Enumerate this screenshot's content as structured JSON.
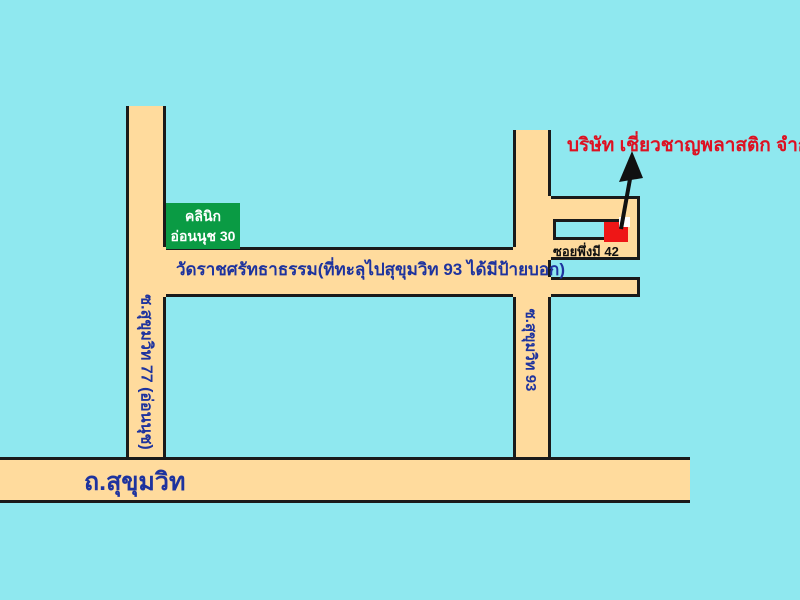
{
  "map": {
    "company_label": "บริษัท เชี่ยวชาญพลาสติก จำกัด",
    "clinic_sign": {
      "line1": "คลินิก",
      "line2": "อ่อนนุช 30"
    },
    "temple_note": "วัดราชศรัทธาธรรม(ที่ทะลุไปสุขุมวิท 93 ได้มีป้ายบอก)",
    "soi_phuengmi_label": "ซอยพึ่งมี 42",
    "left_road_label": "ซ.สุขุมวิท 77 (อ่อนนุช)",
    "right_road_label": "ซ.สุขุมวิท 93",
    "main_road_label": "ถ.สุขุมวิท",
    "colors": {
      "background": "#8fe8ef",
      "road_fill": "#ffdb9d",
      "road_outline": "#1a1a1a",
      "road_text_blue": "#1e339e",
      "company_text_red": "#dd1122",
      "clinic_sign_green": "#0a9b44",
      "clinic_sign_text": "#ffffff",
      "marker_red": "#ee1616",
      "marker_notch_white": "#ffffff",
      "arrow_black": "#111111"
    }
  }
}
